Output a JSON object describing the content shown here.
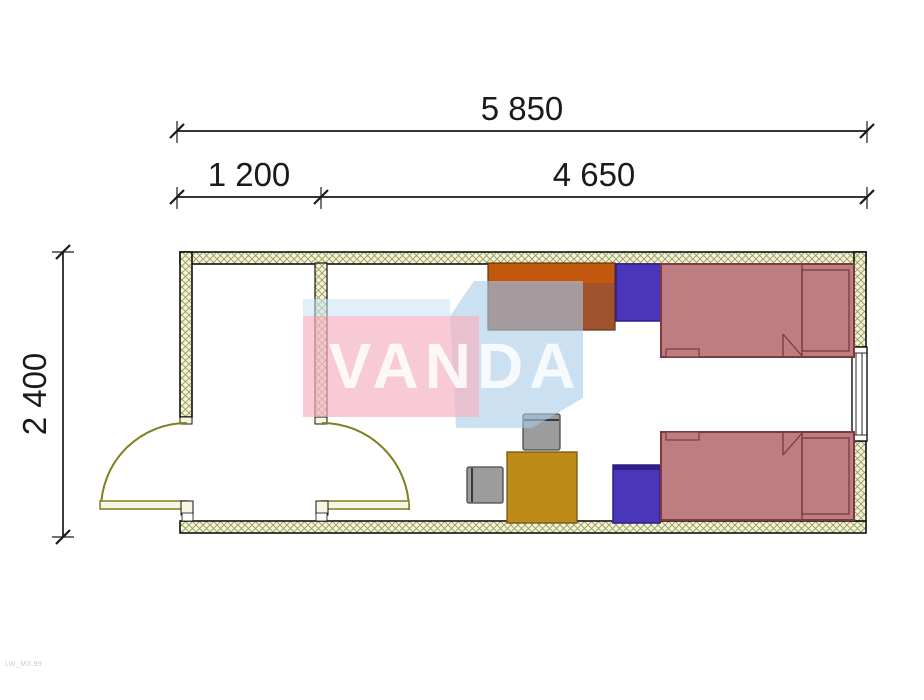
{
  "drawing": {
    "type": "floor-plan",
    "watermark_text": "VANDA",
    "corner_code": "LW_M3.99",
    "dimensions": {
      "overall_width": "5 850",
      "entry_width": "1 200",
      "main_room_width": "4 650",
      "depth": "2 400"
    },
    "furniture": {
      "beds": 2,
      "bedside_cabinets": 2,
      "wardrobe_desk": 1,
      "table": 1,
      "chairs": 2,
      "doors": 2,
      "window": 1
    },
    "colors": {
      "wall_fill": "#F4F4DF",
      "wall_hatch": "#9A9A52",
      "outline": "#111111",
      "door_olive": "#7F7F1E",
      "leaf_fill": "#F6F6E3",
      "bed_fill": "#BE7E81",
      "bed_outline": "#7B3A3E",
      "cabinet_blue": "#4B35B8",
      "cabinet_blue_dark": "#2E1F86",
      "desk_orange": "#C3570E",
      "desk_brown": "#A0522D",
      "table_gold": "#BD8B17",
      "chair_gray": "#9C9C9C",
      "watermark_pink": "#F3B3C3",
      "watermark_blue": "#A9CCE8",
      "watermark_band": "#C9E3F3",
      "dimension_text": "#1A1A1A"
    }
  }
}
